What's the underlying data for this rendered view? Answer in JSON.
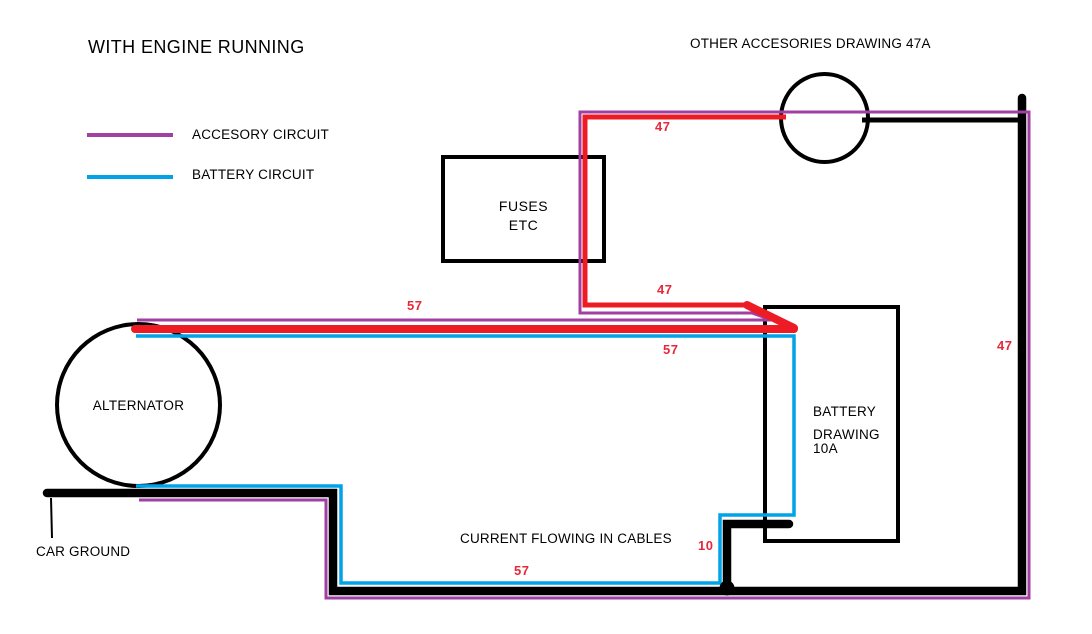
{
  "title": "WITH ENGINE RUNNING",
  "colors": {
    "accessory": "#A23FA2",
    "battery": "#00A2E8",
    "current": "#ED1C24",
    "ground": "#000000",
    "label_red": "#E6283A"
  },
  "legend": {
    "items": [
      {
        "label": "ACCESORY CIRCUIT",
        "color_key": "accessory"
      },
      {
        "label": "BATTERY CIRCUIT",
        "color_key": "battery"
      }
    ]
  },
  "components": {
    "accessories": {
      "label": "OTHER ACCESORIES DRAWING 47A"
    },
    "fuses": {
      "line1": "FUSES",
      "line2": "ETC"
    },
    "battery": {
      "line1": "BATTERY",
      "line2": "DRAWING",
      "line3": "10A"
    },
    "alternator": {
      "label": "ALTERNATOR"
    },
    "car_ground": {
      "label": "CAR GROUND"
    },
    "caption": "CURRENT FLOWING IN CABLES"
  },
  "current_labels": [
    {
      "text": "47",
      "x": 655,
      "y": 121
    },
    {
      "text": "47",
      "x": 657,
      "y": 284
    },
    {
      "text": "47",
      "x": 997,
      "y": 340
    },
    {
      "text": "57",
      "x": 407,
      "y": 300
    },
    {
      "text": "57",
      "x": 663,
      "y": 344
    },
    {
      "text": "57",
      "x": 514,
      "y": 565
    },
    {
      "text": "10",
      "x": 698,
      "y": 540
    }
  ],
  "wires": [
    {
      "name": "ground-path",
      "color": "ground",
      "width": 8.5,
      "cap": "round",
      "points": [
        [
          47,
          493
        ],
        [
          333,
          493
        ],
        [
          333,
          591
        ],
        [
          1022,
          591
        ],
        [
          1022,
          98
        ]
      ]
    },
    {
      "name": "ground-accessories-link",
      "color": "ground",
      "width": 5,
      "cap": "butt",
      "points": [
        [
          862,
          120
        ],
        [
          1022,
          120
        ]
      ]
    },
    {
      "name": "battery-negative-stub",
      "color": "ground",
      "width": 8.5,
      "cap": "round",
      "points": [
        [
          789,
          524
        ],
        [
          727,
          524
        ],
        [
          727,
          585
        ]
      ]
    },
    {
      "name": "car-ground-callout-line",
      "color": "ground",
      "width": 2,
      "cap": "butt",
      "points": [
        [
          51,
          498
        ],
        [
          52,
          538
        ]
      ]
    },
    {
      "name": "battery-circuit-loop",
      "color": "battery",
      "width": 3.5,
      "cap": "butt",
      "points": [
        [
          136,
          336
        ],
        [
          794,
          336
        ],
        [
          794,
          515
        ],
        [
          720,
          515
        ],
        [
          720,
          583
        ],
        [
          341,
          583
        ],
        [
          341,
          486
        ],
        [
          136,
          486
        ]
      ]
    },
    {
      "name": "accessory-circuit-loop",
      "color": "accessory",
      "width": 3,
      "cap": "butt",
      "points": [
        [
          137,
          320
        ],
        [
          772,
          320
        ],
        [
          752,
          313
        ],
        [
          580,
          313
        ],
        [
          580,
          112
        ],
        [
          1029,
          112
        ],
        [
          1029,
          598
        ],
        [
          326,
          598
        ],
        [
          326,
          500
        ],
        [
          139,
          500
        ]
      ]
    },
    {
      "name": "alternator-output-cable",
      "color": "current",
      "width": 8,
      "cap": "round",
      "points": [
        [
          135,
          329
        ],
        [
          794,
          329
        ]
      ]
    },
    {
      "name": "fuse-feed-cable",
      "color": "current",
      "width": 5,
      "cap": "butt",
      "points": [
        [
          786,
          117
        ],
        [
          585,
          117
        ],
        [
          585,
          305
        ],
        [
          748,
          305
        ]
      ]
    },
    {
      "name": "fuse-return-diagonal",
      "color": "current",
      "width": 8,
      "cap": "round",
      "points": [
        [
          747,
          305
        ],
        [
          794,
          328
        ]
      ]
    }
  ],
  "dots": [
    {
      "name": "ground-junction-dot",
      "color": "ground",
      "x": 727,
      "y": 588,
      "r": 7.5
    }
  ]
}
